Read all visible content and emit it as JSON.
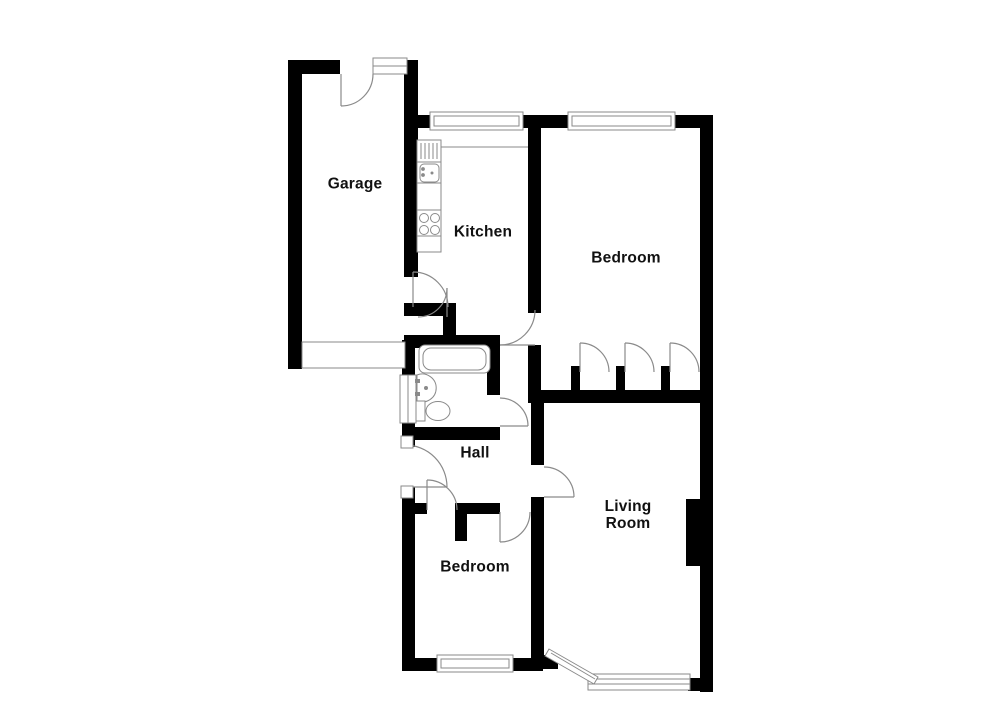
{
  "floor_plan": {
    "rooms": [
      {
        "name": "garage",
        "label": "Garage"
      },
      {
        "name": "kitchen",
        "label": "Kitchen"
      },
      {
        "name": "bedroom-1",
        "label": "Bedroom"
      },
      {
        "name": "hall",
        "label": "Hall"
      },
      {
        "name": "living-room",
        "label": "Living\nRoom"
      },
      {
        "name": "bedroom-2",
        "label": "Bedroom"
      }
    ],
    "fixtures": [
      "bathtub",
      "washbasin",
      "toilet",
      "kitchen-sink-drainer",
      "kitchen-hob",
      "garage-door",
      "chimney-breast",
      "bay-window",
      "built-in-wardrobes"
    ],
    "colors": {
      "wall": "#000000",
      "fixture_line": "#8a8a8a",
      "background": "#ffffff",
      "label_text": "#111111"
    }
  }
}
